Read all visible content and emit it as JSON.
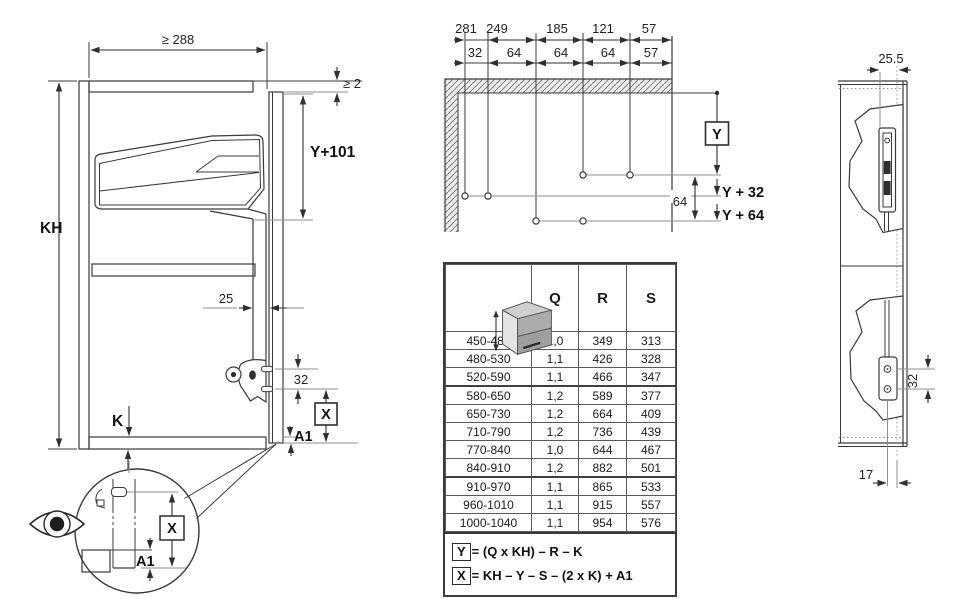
{
  "left_view": {
    "interior_width": "≥ 288",
    "top_gap": "≥ 2",
    "pivot_drop": "Y+101",
    "cabinet_height": "KH",
    "arm_offset": "25",
    "screw_spacing": "32",
    "bottom_thickness": "K",
    "x_dim": "X",
    "a1_dim": "A1",
    "detail": {
      "x_dim": "X",
      "a1_dim": "A1"
    }
  },
  "drilling_view": {
    "to_front": [
      "281",
      "249",
      "185",
      "121",
      "57"
    ],
    "spacing": [
      "32",
      "64",
      "64",
      "64",
      "57"
    ],
    "y_dim": "Y",
    "row_gap": "64",
    "y_plus_32": "Y + 32",
    "y_plus_64": "Y + 64"
  },
  "spec_table": {
    "columns": [
      "Q",
      "R",
      "S"
    ],
    "rows": [
      [
        "450-480",
        "1,0",
        "349",
        "313"
      ],
      [
        "480-530",
        "1,1",
        "426",
        "328"
      ],
      [
        "520-590",
        "1,1",
        "466",
        "347"
      ],
      [
        "580-650",
        "1,2",
        "589",
        "377"
      ],
      [
        "650-730",
        "1,2",
        "664",
        "409"
      ],
      [
        "710-790",
        "1,2",
        "736",
        "439"
      ],
      [
        "770-840",
        "1,0",
        "644",
        "467"
      ],
      [
        "840-910",
        "1,2",
        "882",
        "501"
      ],
      [
        "910-970",
        "1,1",
        "865",
        "533"
      ],
      [
        "960-1010",
        "1,1",
        "915",
        "557"
      ],
      [
        "1000-1040",
        "1,1",
        "954",
        "576"
      ]
    ],
    "formulas": {
      "y_box": "Y",
      "y_expr": "= (Q x KH) – R – K",
      "x_box": "X",
      "x_expr": "= KH – Y – S – (2 x K) + A1"
    }
  },
  "side_view": {
    "front_inset": "25.5",
    "hole_spacing": "32",
    "bottom_inset": "17"
  },
  "colors": {
    "line": "#3a3a3a",
    "dim": "#2f2f2f",
    "ref": "#8f8f8f",
    "hatch_fill": "#ececec"
  }
}
